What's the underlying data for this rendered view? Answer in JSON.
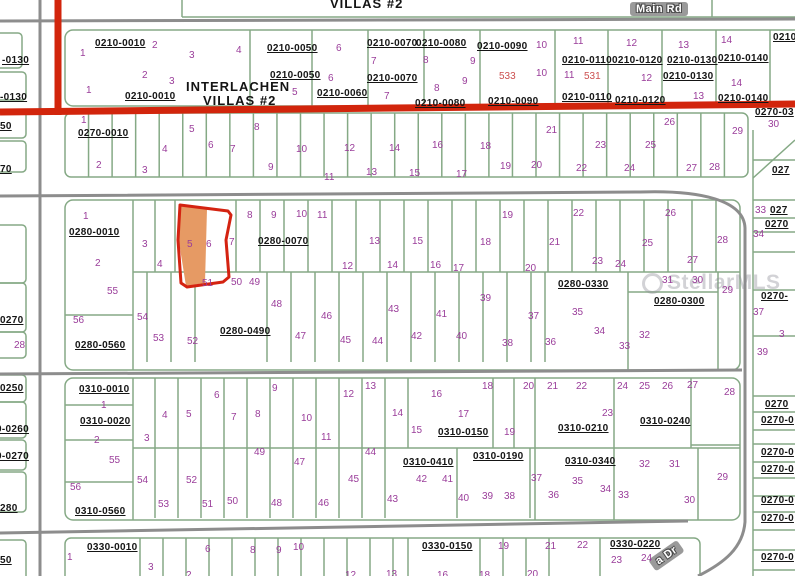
{
  "map": {
    "header": {
      "villas_top": "VILLAS #2",
      "main_rd": "Main Rd",
      "dr_road": "a Dr",
      "subdivision_line1": "INTERLACHEN",
      "subdivision_line2": "VILLAS #2"
    },
    "watermark": "StellarMLS",
    "highlight": {
      "lot": "5",
      "fill": "#e69a64",
      "outline": "#d42311"
    },
    "colors": {
      "parcel_line": "#85a985",
      "road_red": "#d2250c",
      "road_gray": "#8d8d8d",
      "lot_number": "#9a3d9a",
      "red_number": "#cc4f4f"
    },
    "parcel_ids": [
      {
        "t": "0210-0010",
        "x": 95,
        "y": 39
      },
      {
        "t": "0210-0010",
        "x": 125,
        "y": 92
      },
      {
        "t": "0210-0050",
        "x": 267,
        "y": 44
      },
      {
        "t": "0210-0050",
        "x": 270,
        "y": 71
      },
      {
        "t": "0210-0060",
        "x": 317,
        "y": 89
      },
      {
        "t": "0210-0070",
        "x": 367,
        "y": 39
      },
      {
        "t": "0210-0070",
        "x": 367,
        "y": 74
      },
      {
        "t": "0210-0080",
        "x": 416,
        "y": 39
      },
      {
        "t": "0210-0080",
        "x": 415,
        "y": 99
      },
      {
        "t": "0210-0090",
        "x": 477,
        "y": 42
      },
      {
        "t": "0210-0090",
        "x": 488,
        "y": 97
      },
      {
        "t": "0210-0110",
        "x": 562,
        "y": 56
      },
      {
        "t": "0210-0110",
        "x": 562,
        "y": 93
      },
      {
        "t": "0210-0120",
        "x": 612,
        "y": 56
      },
      {
        "t": "0210-0120",
        "x": 615,
        "y": 96
      },
      {
        "t": "0210-0130",
        "x": 667,
        "y": 56
      },
      {
        "t": "0210-0130",
        "x": 663,
        "y": 72
      },
      {
        "t": "0210-0140",
        "x": 718,
        "y": 54
      },
      {
        "t": "0210-0140",
        "x": 718,
        "y": 94
      },
      {
        "t": "0270-0010",
        "x": 78,
        "y": 129
      },
      {
        "t": "0280-0010",
        "x": 69,
        "y": 228
      },
      {
        "t": "0280-0070",
        "x": 258,
        "y": 237
      },
      {
        "t": "0280-0560",
        "x": 75,
        "y": 341
      },
      {
        "t": "0280-0490",
        "x": 220,
        "y": 327
      },
      {
        "t": "0280-0330",
        "x": 558,
        "y": 280
      },
      {
        "t": "0280-0300",
        "x": 654,
        "y": 297
      },
      {
        "t": "0310-0010",
        "x": 79,
        "y": 385
      },
      {
        "t": "0310-0020",
        "x": 80,
        "y": 417
      },
      {
        "t": "0310-0560",
        "x": 75,
        "y": 507
      },
      {
        "t": "0310-0150",
        "x": 438,
        "y": 428
      },
      {
        "t": "0310-0410",
        "x": 403,
        "y": 458
      },
      {
        "t": "0310-0190",
        "x": 473,
        "y": 452
      },
      {
        "t": "0310-0210",
        "x": 558,
        "y": 424
      },
      {
        "t": "0310-0240",
        "x": 640,
        "y": 417
      },
      {
        "t": "0310-0340",
        "x": 565,
        "y": 457
      },
      {
        "t": "0330-0010",
        "x": 87,
        "y": 543
      },
      {
        "t": "0330-0150",
        "x": 422,
        "y": 542
      },
      {
        "t": "0330-0220",
        "x": 610,
        "y": 540
      }
    ],
    "fragments": [
      {
        "t": "-0130",
        "x": 2,
        "y": 56
      },
      {
        "t": "-0130",
        "x": 0,
        "y": 93
      },
      {
        "t": "50",
        "x": 0,
        "y": 122
      },
      {
        "t": "70",
        "x": 0,
        "y": 165
      },
      {
        "t": "0270",
        "x": 0,
        "y": 316
      },
      {
        "t": "0250",
        "x": 0,
        "y": 384
      },
      {
        "t": "0-0260",
        "x": -4,
        "y": 425
      },
      {
        "t": "0-0270",
        "x": -4,
        "y": 452
      },
      {
        "t": "280",
        "x": 0,
        "y": 504
      },
      {
        "t": "50",
        "x": 0,
        "y": 556
      },
      {
        "t": "0210",
        "x": 773,
        "y": 33
      },
      {
        "t": "0270-03",
        "x": 755,
        "y": 108
      },
      {
        "t": "027",
        "x": 772,
        "y": 166
      },
      {
        "t": "027",
        "x": 770,
        "y": 206
      },
      {
        "t": "0270",
        "x": 765,
        "y": 220
      },
      {
        "t": "0270-",
        "x": 761,
        "y": 292
      },
      {
        "t": "0270",
        "x": 765,
        "y": 400
      },
      {
        "t": "0270-0",
        "x": 761,
        "y": 416
      },
      {
        "t": "0270-0",
        "x": 761,
        "y": 448
      },
      {
        "t": "0270-0",
        "x": 761,
        "y": 465
      },
      {
        "t": "0270-0",
        "x": 761,
        "y": 496
      },
      {
        "t": "0270-0",
        "x": 761,
        "y": 514
      },
      {
        "t": "0270-0",
        "x": 761,
        "y": 553
      }
    ],
    "red_numbers": [
      {
        "t": "533",
        "x": 499,
        "y": 72
      },
      {
        "t": "531",
        "x": 584,
        "y": 72
      }
    ],
    "lot_numbers": [
      {
        "t": "1",
        "x": 80,
        "y": 49
      },
      {
        "t": "2",
        "x": 152,
        "y": 41
      },
      {
        "t": "3",
        "x": 189,
        "y": 51
      },
      {
        "t": "4",
        "x": 236,
        "y": 46
      },
      {
        "t": "2",
        "x": 142,
        "y": 71
      },
      {
        "t": "3",
        "x": 169,
        "y": 77
      },
      {
        "t": "1",
        "x": 86,
        "y": 86
      },
      {
        "t": "5",
        "x": 292,
        "y": 88
      },
      {
        "t": "6",
        "x": 336,
        "y": 44
      },
      {
        "t": "6",
        "x": 328,
        "y": 74
      },
      {
        "t": "7",
        "x": 371,
        "y": 57
      },
      {
        "t": "7",
        "x": 384,
        "y": 92
      },
      {
        "t": "8",
        "x": 423,
        "y": 56
      },
      {
        "t": "8",
        "x": 434,
        "y": 84
      },
      {
        "t": "9",
        "x": 470,
        "y": 57
      },
      {
        "t": "9",
        "x": 462,
        "y": 77
      },
      {
        "t": "10",
        "x": 536,
        "y": 41
      },
      {
        "t": "10",
        "x": 536,
        "y": 69
      },
      {
        "t": "11",
        "x": 573,
        "y": 37
      },
      {
        "t": "11",
        "x": 564,
        "y": 71
      },
      {
        "t": "12",
        "x": 626,
        "y": 39
      },
      {
        "t": "12",
        "x": 641,
        "y": 74
      },
      {
        "t": "13",
        "x": 678,
        "y": 41
      },
      {
        "t": "13",
        "x": 693,
        "y": 92
      },
      {
        "t": "14",
        "x": 721,
        "y": 36
      },
      {
        "t": "14",
        "x": 731,
        "y": 79
      },
      {
        "t": "1",
        "x": 81,
        "y": 116
      },
      {
        "t": "2",
        "x": 96,
        "y": 161
      },
      {
        "t": "3",
        "x": 142,
        "y": 166
      },
      {
        "t": "4",
        "x": 162,
        "y": 145
      },
      {
        "t": "5",
        "x": 189,
        "y": 125
      },
      {
        "t": "6",
        "x": 208,
        "y": 141
      },
      {
        "t": "7",
        "x": 230,
        "y": 145
      },
      {
        "t": "8",
        "x": 254,
        "y": 123
      },
      {
        "t": "9",
        "x": 268,
        "y": 163
      },
      {
        "t": "10",
        "x": 296,
        "y": 145
      },
      {
        "t": "11",
        "x": 324,
        "y": 173
      },
      {
        "t": "12",
        "x": 344,
        "y": 144
      },
      {
        "t": "13",
        "x": 366,
        "y": 168
      },
      {
        "t": "14",
        "x": 389,
        "y": 144
      },
      {
        "t": "15",
        "x": 409,
        "y": 169
      },
      {
        "t": "16",
        "x": 432,
        "y": 141
      },
      {
        "t": "17",
        "x": 456,
        "y": 170
      },
      {
        "t": "18",
        "x": 480,
        "y": 142
      },
      {
        "t": "19",
        "x": 500,
        "y": 162
      },
      {
        "t": "20",
        "x": 531,
        "y": 161
      },
      {
        "t": "21",
        "x": 546,
        "y": 126
      },
      {
        "t": "22",
        "x": 576,
        "y": 164
      },
      {
        "t": "23",
        "x": 595,
        "y": 141
      },
      {
        "t": "24",
        "x": 624,
        "y": 164
      },
      {
        "t": "25",
        "x": 645,
        "y": 141
      },
      {
        "t": "26",
        "x": 664,
        "y": 118
      },
      {
        "t": "27",
        "x": 686,
        "y": 164
      },
      {
        "t": "28",
        "x": 709,
        "y": 163
      },
      {
        "t": "29",
        "x": 732,
        "y": 127
      },
      {
        "t": "1",
        "x": 83,
        "y": 212
      },
      {
        "t": "2",
        "x": 95,
        "y": 259
      },
      {
        "t": "3",
        "x": 142,
        "y": 240
      },
      {
        "t": "4",
        "x": 157,
        "y": 260
      },
      {
        "t": "5",
        "x": 187,
        "y": 240
      },
      {
        "t": "6",
        "x": 206,
        "y": 240
      },
      {
        "t": "7",
        "x": 229,
        "y": 238
      },
      {
        "t": "8",
        "x": 247,
        "y": 211
      },
      {
        "t": "9",
        "x": 271,
        "y": 211
      },
      {
        "t": "10",
        "x": 296,
        "y": 210
      },
      {
        "t": "11",
        "x": 317,
        "y": 211
      },
      {
        "t": "12",
        "x": 342,
        "y": 262
      },
      {
        "t": "13",
        "x": 369,
        "y": 237
      },
      {
        "t": "14",
        "x": 387,
        "y": 261
      },
      {
        "t": "15",
        "x": 412,
        "y": 237
      },
      {
        "t": "16",
        "x": 430,
        "y": 261
      },
      {
        "t": "17",
        "x": 453,
        "y": 264
      },
      {
        "t": "18",
        "x": 480,
        "y": 238
      },
      {
        "t": "19",
        "x": 502,
        "y": 211
      },
      {
        "t": "20",
        "x": 525,
        "y": 264
      },
      {
        "t": "21",
        "x": 549,
        "y": 238
      },
      {
        "t": "22",
        "x": 573,
        "y": 209
      },
      {
        "t": "23",
        "x": 592,
        "y": 257
      },
      {
        "t": "24",
        "x": 615,
        "y": 260
      },
      {
        "t": "25",
        "x": 642,
        "y": 239
      },
      {
        "t": "26",
        "x": 665,
        "y": 209
      },
      {
        "t": "27",
        "x": 687,
        "y": 256
      },
      {
        "t": "28",
        "x": 717,
        "y": 236
      },
      {
        "t": "29",
        "x": 722,
        "y": 286
      },
      {
        "t": "30",
        "x": 692,
        "y": 276
      },
      {
        "t": "31",
        "x": 662,
        "y": 276
      },
      {
        "t": "32",
        "x": 639,
        "y": 331
      },
      {
        "t": "33",
        "x": 619,
        "y": 342
      },
      {
        "t": "34",
        "x": 594,
        "y": 327
      },
      {
        "t": "35",
        "x": 572,
        "y": 308
      },
      {
        "t": "36",
        "x": 545,
        "y": 338
      },
      {
        "t": "37",
        "x": 528,
        "y": 312
      },
      {
        "t": "38",
        "x": 502,
        "y": 339
      },
      {
        "t": "39",
        "x": 480,
        "y": 294
      },
      {
        "t": "40",
        "x": 456,
        "y": 332
      },
      {
        "t": "41",
        "x": 436,
        "y": 310
      },
      {
        "t": "42",
        "x": 411,
        "y": 332
      },
      {
        "t": "43",
        "x": 388,
        "y": 305
      },
      {
        "t": "44",
        "x": 372,
        "y": 337
      },
      {
        "t": "45",
        "x": 340,
        "y": 336
      },
      {
        "t": "46",
        "x": 321,
        "y": 312
      },
      {
        "t": "47",
        "x": 295,
        "y": 332
      },
      {
        "t": "48",
        "x": 271,
        "y": 300
      },
      {
        "t": "49",
        "x": 249,
        "y": 278
      },
      {
        "t": "50",
        "x": 231,
        "y": 278
      },
      {
        "t": "51",
        "x": 202,
        "y": 279
      },
      {
        "t": "52",
        "x": 187,
        "y": 337
      },
      {
        "t": "53",
        "x": 153,
        "y": 334
      },
      {
        "t": "54",
        "x": 137,
        "y": 313
      },
      {
        "t": "55",
        "x": 107,
        "y": 287
      },
      {
        "t": "56",
        "x": 73,
        "y": 316
      },
      {
        "t": "1",
        "x": 101,
        "y": 401
      },
      {
        "t": "2",
        "x": 94,
        "y": 436
      },
      {
        "t": "3",
        "x": 144,
        "y": 434
      },
      {
        "t": "4",
        "x": 162,
        "y": 411
      },
      {
        "t": "5",
        "x": 186,
        "y": 410
      },
      {
        "t": "6",
        "x": 214,
        "y": 391
      },
      {
        "t": "7",
        "x": 231,
        "y": 413
      },
      {
        "t": "8",
        "x": 255,
        "y": 410
      },
      {
        "t": "9",
        "x": 272,
        "y": 384
      },
      {
        "t": "10",
        "x": 301,
        "y": 414
      },
      {
        "t": "11",
        "x": 321,
        "y": 433
      },
      {
        "t": "12",
        "x": 343,
        "y": 390
      },
      {
        "t": "13",
        "x": 365,
        "y": 382
      },
      {
        "t": "14",
        "x": 392,
        "y": 409
      },
      {
        "t": "15",
        "x": 411,
        "y": 426
      },
      {
        "t": "16",
        "x": 431,
        "y": 390
      },
      {
        "t": "17",
        "x": 458,
        "y": 410
      },
      {
        "t": "18",
        "x": 482,
        "y": 382
      },
      {
        "t": "19",
        "x": 504,
        "y": 428
      },
      {
        "t": "20",
        "x": 523,
        "y": 382
      },
      {
        "t": "21",
        "x": 547,
        "y": 382
      },
      {
        "t": "22",
        "x": 576,
        "y": 382
      },
      {
        "t": "23",
        "x": 602,
        "y": 409
      },
      {
        "t": "24",
        "x": 617,
        "y": 382
      },
      {
        "t": "25",
        "x": 639,
        "y": 382
      },
      {
        "t": "26",
        "x": 662,
        "y": 382
      },
      {
        "t": "27",
        "x": 687,
        "y": 381
      },
      {
        "t": "28",
        "x": 724,
        "y": 388
      },
      {
        "t": "29",
        "x": 717,
        "y": 473
      },
      {
        "t": "30",
        "x": 684,
        "y": 496
      },
      {
        "t": "31",
        "x": 669,
        "y": 460
      },
      {
        "t": "32",
        "x": 639,
        "y": 460
      },
      {
        "t": "33",
        "x": 618,
        "y": 491
      },
      {
        "t": "34",
        "x": 600,
        "y": 485
      },
      {
        "t": "35",
        "x": 572,
        "y": 477
      },
      {
        "t": "36",
        "x": 548,
        "y": 491
      },
      {
        "t": "37",
        "x": 531,
        "y": 474
      },
      {
        "t": "38",
        "x": 504,
        "y": 492
      },
      {
        "t": "39",
        "x": 482,
        "y": 492
      },
      {
        "t": "40",
        "x": 458,
        "y": 494
      },
      {
        "t": "41",
        "x": 442,
        "y": 475
      },
      {
        "t": "42",
        "x": 416,
        "y": 475
      },
      {
        "t": "43",
        "x": 387,
        "y": 495
      },
      {
        "t": "44",
        "x": 365,
        "y": 448
      },
      {
        "t": "45",
        "x": 348,
        "y": 475
      },
      {
        "t": "46",
        "x": 318,
        "y": 499
      },
      {
        "t": "47",
        "x": 294,
        "y": 458
      },
      {
        "t": "48",
        "x": 271,
        "y": 499
      },
      {
        "t": "49",
        "x": 254,
        "y": 448
      },
      {
        "t": "50",
        "x": 227,
        "y": 497
      },
      {
        "t": "51",
        "x": 202,
        "y": 500
      },
      {
        "t": "52",
        "x": 186,
        "y": 476
      },
      {
        "t": "53",
        "x": 158,
        "y": 500
      },
      {
        "t": "54",
        "x": 137,
        "y": 476
      },
      {
        "t": "55",
        "x": 109,
        "y": 456
      },
      {
        "t": "56",
        "x": 70,
        "y": 483
      },
      {
        "t": "1",
        "x": 67,
        "y": 553
      },
      {
        "t": "3",
        "x": 148,
        "y": 563
      },
      {
        "t": "6",
        "x": 205,
        "y": 545
      },
      {
        "t": "8",
        "x": 250,
        "y": 546
      },
      {
        "t": "9",
        "x": 276,
        "y": 546
      },
      {
        "t": "10",
        "x": 293,
        "y": 543
      },
      {
        "t": "2",
        "x": 186,
        "y": 571
      },
      {
        "t": "12",
        "x": 345,
        "y": 571
      },
      {
        "t": "13",
        "x": 386,
        "y": 570
      },
      {
        "t": "16",
        "x": 437,
        "y": 571
      },
      {
        "t": "18",
        "x": 479,
        "y": 571
      },
      {
        "t": "19",
        "x": 498,
        "y": 542
      },
      {
        "t": "20",
        "x": 527,
        "y": 570
      },
      {
        "t": "21",
        "x": 545,
        "y": 542
      },
      {
        "t": "22",
        "x": 577,
        "y": 541
      },
      {
        "t": "23",
        "x": 611,
        "y": 556
      },
      {
        "t": "24",
        "x": 641,
        "y": 554
      },
      {
        "t": "28",
        "x": 14,
        "y": 341
      },
      {
        "t": "30",
        "x": 768,
        "y": 120
      },
      {
        "t": "33",
        "x": 755,
        "y": 206
      },
      {
        "t": "34",
        "x": 753,
        "y": 230
      },
      {
        "t": "37",
        "x": 753,
        "y": 308
      },
      {
        "t": "3",
        "x": 779,
        "y": 330
      },
      {
        "t": "39",
        "x": 757,
        "y": 348
      }
    ]
  }
}
